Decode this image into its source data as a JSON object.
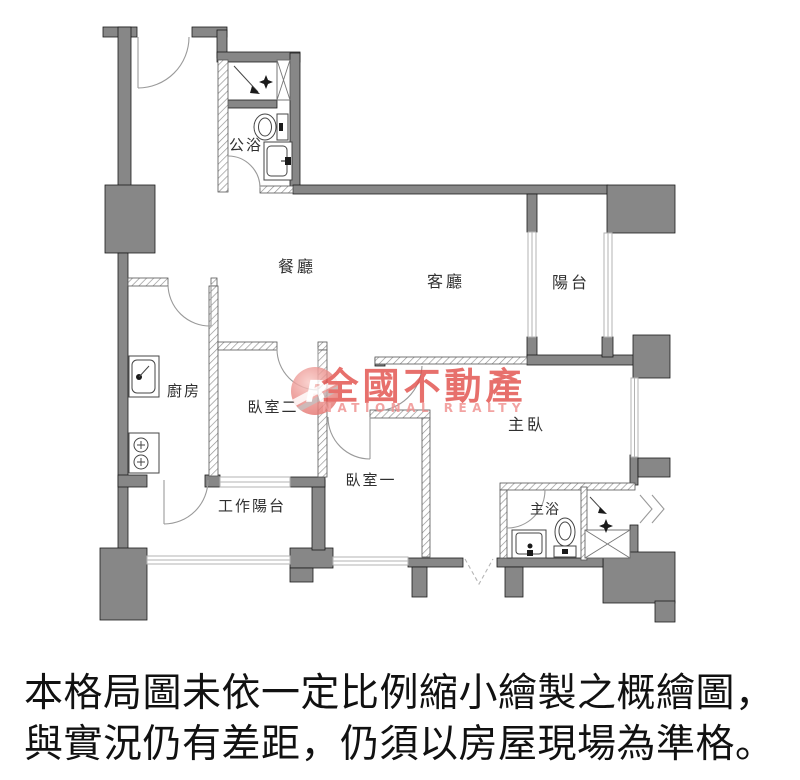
{
  "floorplan": {
    "rooms": [
      {
        "id": "public-bath",
        "label": "公浴"
      },
      {
        "id": "dining",
        "label": "餐廳"
      },
      {
        "id": "living",
        "label": "客廳"
      },
      {
        "id": "balcony",
        "label": "陽台"
      },
      {
        "id": "kitchen",
        "label": "廚房"
      },
      {
        "id": "bedroom2",
        "label": "臥室二"
      },
      {
        "id": "bedroom1",
        "label": "臥室一"
      },
      {
        "id": "master-bedroom",
        "label": "主臥"
      },
      {
        "id": "master-bath",
        "label": "主浴"
      },
      {
        "id": "work-balcony",
        "label": "工作陽台"
      }
    ],
    "colors": {
      "wall": "#878787",
      "wall_outline": "#1b1b1b",
      "hatch": "#8f8f8f",
      "window": "#b3b3b3",
      "door_arc": "#9a9a9a",
      "fixture": "#454545",
      "label": "#2f2f2f"
    }
  },
  "watermark": {
    "logo_letter": "R",
    "brand": "全國不動產",
    "brand_en": "NATIONAL REALTY",
    "color": "#e2514d",
    "color_light": "#f0908e"
  },
  "disclaimer": {
    "line1": "本格局圖未依一定比例縮小繪製之概繪圖，",
    "line2": "與實況仍有差距，仍須以房屋現場為準格。"
  }
}
